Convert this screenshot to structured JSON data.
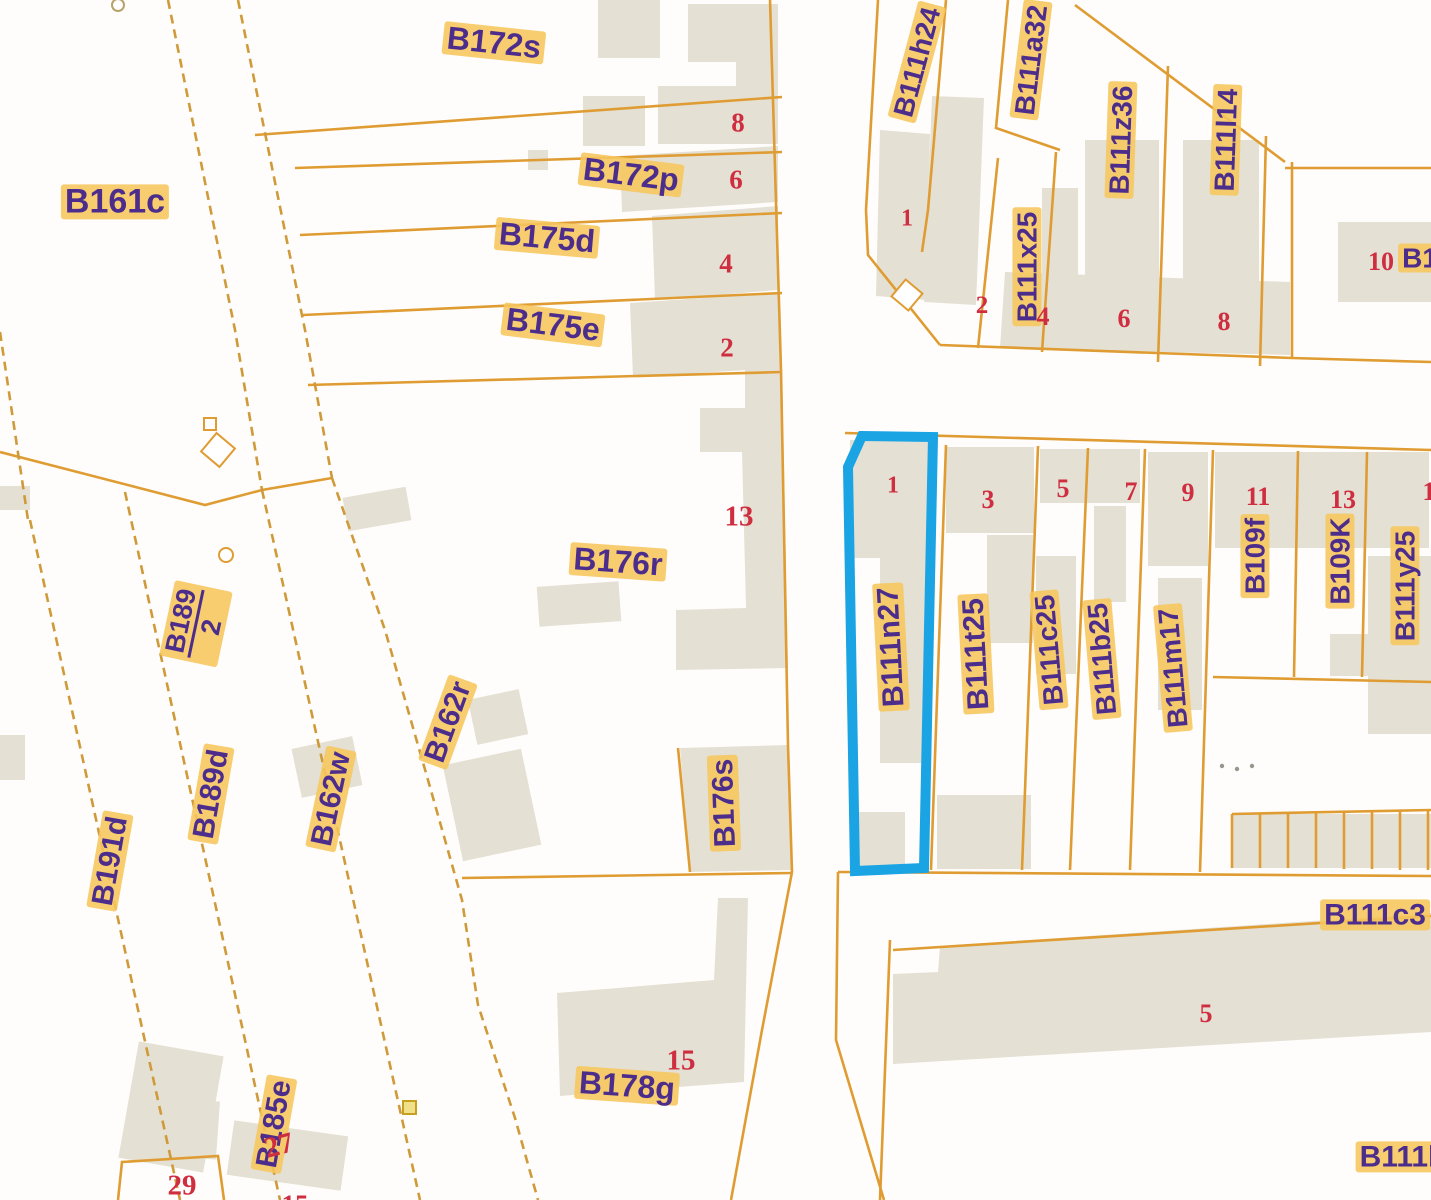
{
  "map_meta": {
    "type": "cadastral-parcel-map",
    "background": "#fffdfb",
    "parcel_line_color": "#df9c32",
    "dashed_line_color": "#cf9a3a",
    "building_fill": "#e5e0d4",
    "label_text_color": "#4c2d8c",
    "label_halo_color": "#f6c65c",
    "house_number_color": "#cf2e40",
    "highlight_color": "#1ba4e4"
  },
  "highlighted_parcel": {
    "id": "B111n27",
    "house_number": "1"
  },
  "parcel_labels": [
    {
      "text": "B161c"
    },
    {
      "text": "B172s"
    },
    {
      "text": "B172p"
    },
    {
      "text": "B175d"
    },
    {
      "text": "B175e"
    },
    {
      "text": "B176r"
    },
    {
      "text": "B176s"
    },
    {
      "text": "B178g"
    },
    {
      "text": "B162r"
    },
    {
      "text": "B162w"
    },
    {
      "text": "B189",
      "denominator": "2"
    },
    {
      "text": "B189d"
    },
    {
      "text": "B191d"
    },
    {
      "text": "B185e"
    },
    {
      "text": "B111h24"
    },
    {
      "text": "B111a32"
    },
    {
      "text": "B111x25"
    },
    {
      "text": "B111z36"
    },
    {
      "text": "B111l14"
    },
    {
      "text": "B111n27"
    },
    {
      "text": "B111t25"
    },
    {
      "text": "B111c25"
    },
    {
      "text": "B111b25"
    },
    {
      "text": "B111m17"
    },
    {
      "text": "B109f"
    },
    {
      "text": "B109K"
    },
    {
      "text": "B111y25"
    },
    {
      "text": "B111c3"
    },
    {
      "text": "B111l"
    },
    {
      "text": "B1"
    }
  ],
  "house_numbers": [
    {
      "text": "8"
    },
    {
      "text": "6"
    },
    {
      "text": "4"
    },
    {
      "text": "2"
    },
    {
      "text": "13"
    },
    {
      "text": "15"
    },
    {
      "text": "1"
    },
    {
      "text": "2"
    },
    {
      "text": "4"
    },
    {
      "text": "6"
    },
    {
      "text": "8"
    },
    {
      "text": "1"
    },
    {
      "text": "3"
    },
    {
      "text": "5"
    },
    {
      "text": "7"
    },
    {
      "text": "9"
    },
    {
      "text": "11"
    },
    {
      "text": "13"
    },
    {
      "text": "1"
    },
    {
      "text": "5"
    },
    {
      "text": "27"
    },
    {
      "text": "29"
    },
    {
      "text": "15"
    },
    {
      "text": "10"
    }
  ]
}
